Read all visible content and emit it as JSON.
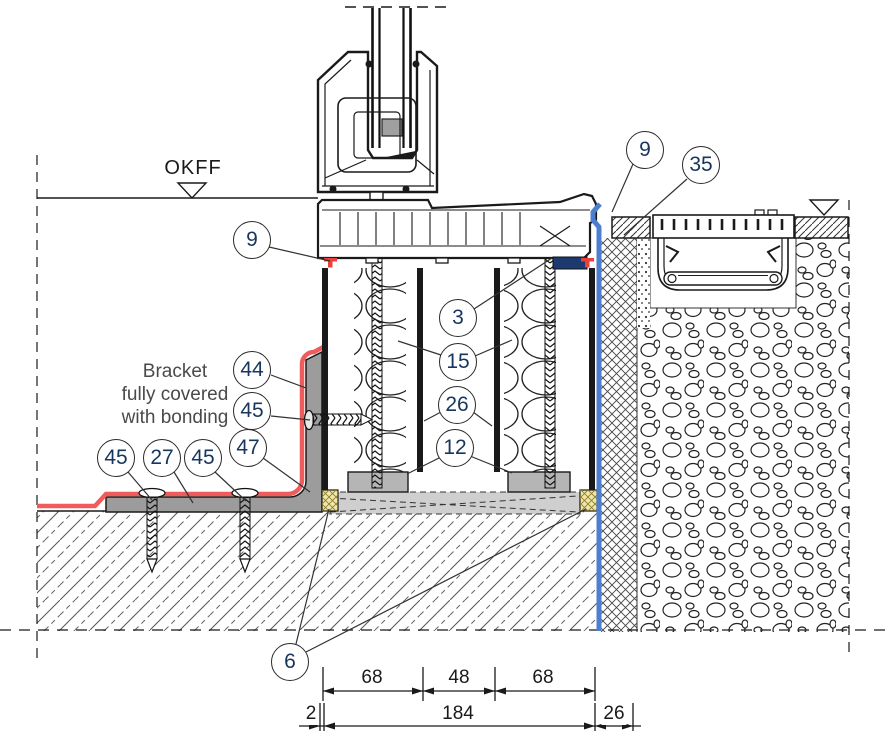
{
  "drawing": {
    "level_label": "OKFF",
    "note_lines": {
      "l1": "Bracket",
      "l2": "fully covered",
      "l3": "with bonding"
    }
  },
  "callouts": [
    {
      "id": "9-left",
      "label": "9"
    },
    {
      "id": "9-right",
      "label": "9"
    },
    {
      "id": "35",
      "label": "35"
    },
    {
      "id": "3",
      "label": "3"
    },
    {
      "id": "15",
      "label": "15"
    },
    {
      "id": "26",
      "label": "26"
    },
    {
      "id": "12",
      "label": "12"
    },
    {
      "id": "44",
      "label": "44"
    },
    {
      "id": "45-upper",
      "label": "45"
    },
    {
      "id": "47",
      "label": "47"
    },
    {
      "id": "45-left",
      "label": "45"
    },
    {
      "id": "27",
      "label": "27"
    },
    {
      "id": "45-mid",
      "label": "45"
    },
    {
      "id": "6",
      "label": "6"
    }
  ],
  "dimensions": {
    "row1": [
      {
        "label": "68"
      },
      {
        "label": "48"
      },
      {
        "label": "68"
      }
    ],
    "row2": [
      {
        "label": "2"
      },
      {
        "label": "184"
      },
      {
        "label": "26"
      }
    ]
  },
  "colors": {
    "membrane_red": "#f05c5c",
    "seal_red": "#e8403a",
    "flashing_blue": "#4d7fd1",
    "compriband_navy": "#1d3a70",
    "seal_yellow": "#efe6a8",
    "bracket_gray": "#9c9c9c",
    "packer_gray": "#b5b5b5",
    "adhesive_bed_gray": "#cfcfcf",
    "line_black": "#1a1a1a"
  }
}
